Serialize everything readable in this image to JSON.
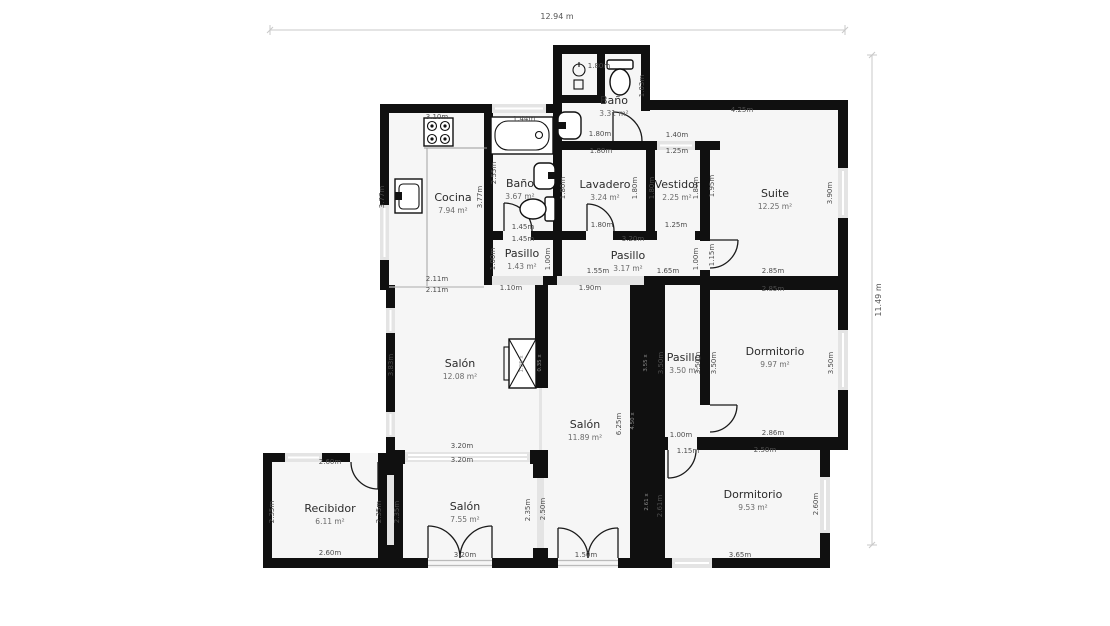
{
  "scale": {
    "width_label": "12.94 m",
    "height_label": "11.49 m"
  },
  "colors": {
    "wall": "#101010",
    "floor": "#f6f6f6",
    "opening": "#e4e4e4",
    "dim_text": "#4d4d4d",
    "room_text": "#2b2b2b"
  },
  "rooms": [
    {
      "id": "bano-top",
      "name": "Baño",
      "area": "3.31 m²",
      "x": 614,
      "y": 104
    },
    {
      "id": "cocina",
      "name": "Cocina",
      "area": "7.94 m²",
      "x": 453,
      "y": 201
    },
    {
      "id": "bano-mid",
      "name": "Baño",
      "area": "3.67 m²",
      "x": 520,
      "y": 187
    },
    {
      "id": "lavadero",
      "name": "Lavadero",
      "area": "3.24 m²",
      "x": 605,
      "y": 188
    },
    {
      "id": "vestidor",
      "name": "Vestidor",
      "area": "2.25 m²",
      "x": 677,
      "y": 188
    },
    {
      "id": "suite",
      "name": "Suite",
      "area": "12.25 m²",
      "x": 775,
      "y": 197
    },
    {
      "id": "pasillo-1",
      "name": "Pasillo",
      "area": "1.43 m²",
      "x": 522,
      "y": 257
    },
    {
      "id": "pasillo-2",
      "name": "Pasillo",
      "area": "3.17 m²",
      "x": 628,
      "y": 259
    },
    {
      "id": "salon-1",
      "name": "Salón",
      "area": "12.08 m²",
      "x": 460,
      "y": 367
    },
    {
      "id": "salon-2",
      "name": "Salón",
      "area": "11.89 m²",
      "x": 585,
      "y": 428
    },
    {
      "id": "pasillo-3",
      "name": "Pasillo",
      "area": "3.50 m²",
      "x": 684,
      "y": 361
    },
    {
      "id": "dormitorio-1",
      "name": "Dormitorio",
      "area": "9.97 m²",
      "x": 775,
      "y": 355
    },
    {
      "id": "recibidor",
      "name": "Recibidor",
      "area": "6.11 m²",
      "x": 330,
      "y": 512
    },
    {
      "id": "salon-3",
      "name": "Salón",
      "area": "7.55 m²",
      "x": 465,
      "y": 510
    },
    {
      "id": "dormitorio-2",
      "name": "Dormitorio",
      "area": "9.53 m²",
      "x": 753,
      "y": 498
    }
  ],
  "dims": [
    {
      "t": "1.80m",
      "x": 599,
      "y": 68
    },
    {
      "t": "1.03m",
      "x": 644,
      "y": 86,
      "r": 1
    },
    {
      "t": "1.80m",
      "x": 600,
      "y": 136
    },
    {
      "t": "1.80m",
      "x": 601,
      "y": 153
    },
    {
      "t": "1.40m",
      "x": 677,
      "y": 137
    },
    {
      "t": "1.25m",
      "x": 677,
      "y": 153
    },
    {
      "t": "4.25m",
      "x": 742,
      "y": 112
    },
    {
      "t": "3.10m",
      "x": 437,
      "y": 119
    },
    {
      "t": "1.44m",
      "x": 524,
      "y": 121
    },
    {
      "t": "2.55m",
      "x": 496,
      "y": 173,
      "r": 1
    },
    {
      "t": "3.77m",
      "x": 482,
      "y": 197,
      "r": 1
    },
    {
      "t": "3.77m",
      "x": 384,
      "y": 197,
      "r": 1
    },
    {
      "t": "1.80m",
      "x": 565,
      "y": 188,
      "r": 1
    },
    {
      "t": "1.80m",
      "x": 637,
      "y": 188,
      "r": 1
    },
    {
      "t": "1.80m",
      "x": 654,
      "y": 188,
      "r": 1
    },
    {
      "t": "1.80m",
      "x": 698,
      "y": 188,
      "r": 1
    },
    {
      "t": "1.95m",
      "x": 714,
      "y": 186,
      "r": 1
    },
    {
      "t": "3.90m",
      "x": 832,
      "y": 193,
      "r": 1
    },
    {
      "t": "1.45m",
      "x": 523,
      "y": 229
    },
    {
      "t": "1.45m",
      "x": 523,
      "y": 241
    },
    {
      "t": "1.80m",
      "x": 602,
      "y": 227
    },
    {
      "t": "1.25m",
      "x": 676,
      "y": 227
    },
    {
      "t": "3.20m",
      "x": 633,
      "y": 241
    },
    {
      "t": "1.00m",
      "x": 495,
      "y": 259,
      "r": 1
    },
    {
      "t": "1.00m",
      "x": 550,
      "y": 259,
      "r": 1
    },
    {
      "t": "1.00m",
      "x": 698,
      "y": 259,
      "r": 1
    },
    {
      "t": "1.15m",
      "x": 714,
      "y": 255,
      "r": 1
    },
    {
      "t": "1.55m",
      "x": 598,
      "y": 273
    },
    {
      "t": "1.65m",
      "x": 668,
      "y": 273
    },
    {
      "t": "2.85m",
      "x": 773,
      "y": 273
    },
    {
      "t": "1.10m",
      "x": 511,
      "y": 290
    },
    {
      "t": "1.90m",
      "x": 590,
      "y": 290
    },
    {
      "t": "2.85m",
      "x": 773,
      "y": 291
    },
    {
      "t": "2.11m",
      "x": 437,
      "y": 281
    },
    {
      "t": "2.11m",
      "x": 437,
      "y": 292
    },
    {
      "t": "3.83m",
      "x": 393,
      "y": 365,
      "r": 1
    },
    {
      "t": "6.25m",
      "x": 621,
      "y": 424,
      "r": 1
    },
    {
      "t": "3.50m",
      "x": 663,
      "y": 363,
      "r": 1
    },
    {
      "t": "3.50m",
      "x": 700,
      "y": 363,
      "r": 1
    },
    {
      "t": "3.50m",
      "x": 716,
      "y": 363,
      "r": 1
    },
    {
      "t": "3.50m",
      "x": 833,
      "y": 363,
      "r": 1
    },
    {
      "t": "3.20m",
      "x": 462,
      "y": 448
    },
    {
      "t": "3.20m",
      "x": 462,
      "y": 462
    },
    {
      "t": "2.86m",
      "x": 773,
      "y": 435
    },
    {
      "t": "2.50m",
      "x": 765,
      "y": 452
    },
    {
      "t": "1.00m",
      "x": 681,
      "y": 437
    },
    {
      "t": "1.15m",
      "x": 688,
      "y": 453
    },
    {
      "t": "2.60m",
      "x": 330,
      "y": 464
    },
    {
      "t": "2.35m",
      "x": 274,
      "y": 512,
      "r": 1
    },
    {
      "t": "2.35m",
      "x": 381,
      "y": 512,
      "r": 1
    },
    {
      "t": "2.35m",
      "x": 399,
      "y": 512,
      "r": 1
    },
    {
      "t": "2.35m",
      "x": 530,
      "y": 510,
      "r": 1
    },
    {
      "t": "2.50m",
      "x": 545,
      "y": 509,
      "r": 1
    },
    {
      "t": "2.61m",
      "x": 662,
      "y": 506,
      "r": 1
    },
    {
      "t": "2.60m",
      "x": 818,
      "y": 504,
      "r": 1
    },
    {
      "t": "2.60m",
      "x": 330,
      "y": 555
    },
    {
      "t": "3.20m",
      "x": 465,
      "y": 557
    },
    {
      "t": "1.50m",
      "x": 586,
      "y": 557
    },
    {
      "t": "3.65m",
      "x": 740,
      "y": 557
    }
  ],
  "faint": [
    {
      "t": "3.55 x",
      "x": 647,
      "y": 363
    },
    {
      "t": "4.50 x",
      "x": 634,
      "y": 421
    },
    {
      "t": "2.61 x",
      "x": 648,
      "y": 502
    },
    {
      "t": "0.35 x",
      "x": 541,
      "y": 363
    },
    {
      "t": "1.05 x",
      "x": 523,
      "y": 364
    }
  ]
}
